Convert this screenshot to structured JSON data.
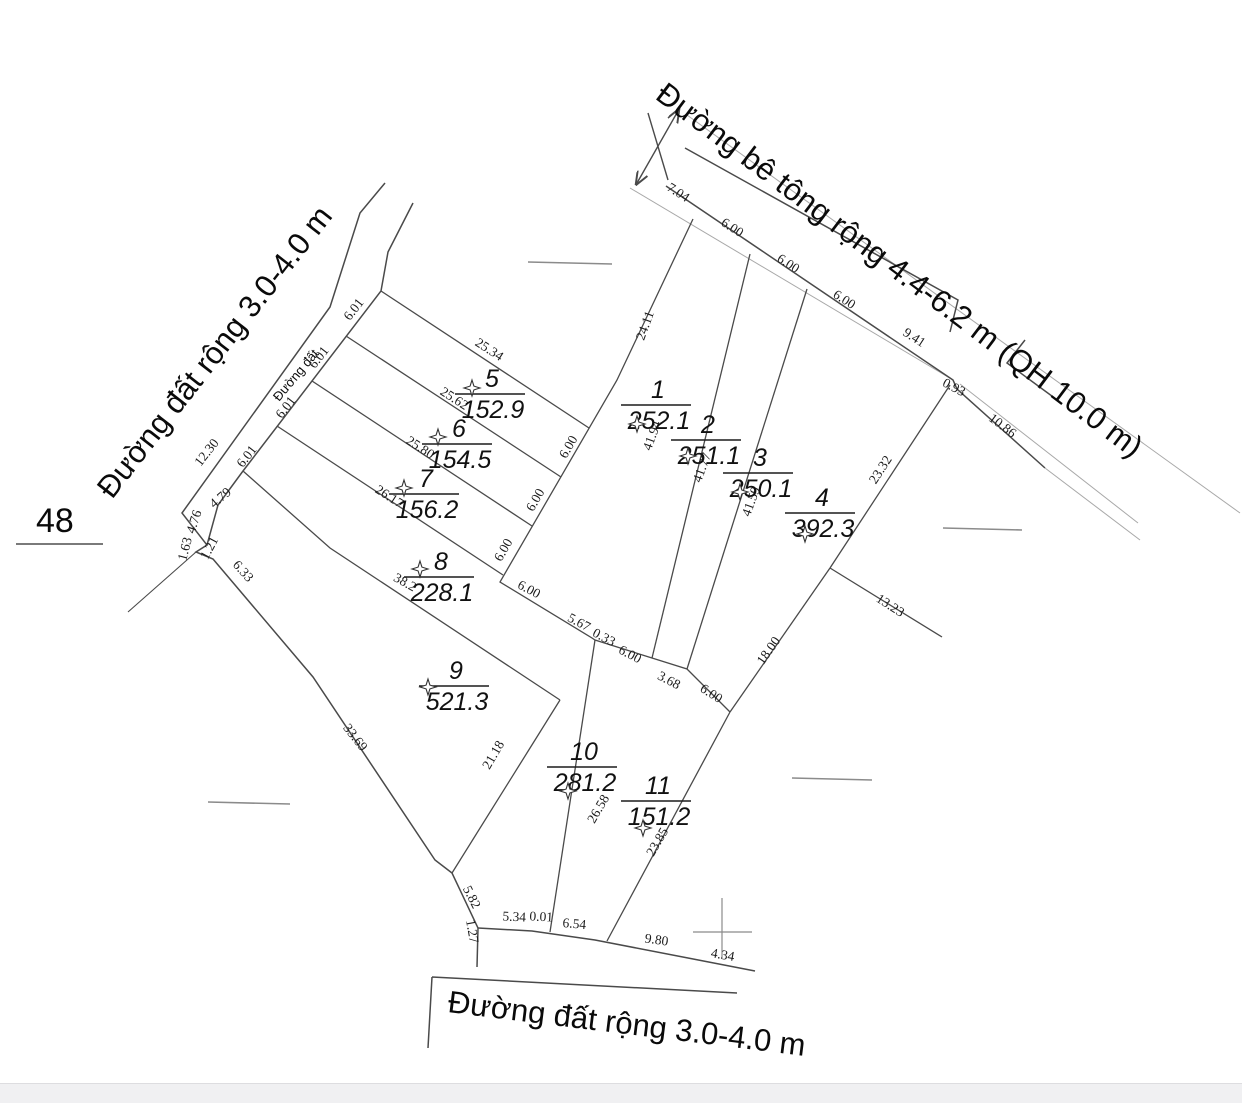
{
  "drawing": {
    "colors": {
      "line": "#4a4a4a",
      "thin_line": "#a0a0a0",
      "text": "#1c1c1c",
      "footer_bar": "#f0f0f2"
    },
    "block_number": {
      "text": "48",
      "x": 36,
      "y": 532,
      "size": 34,
      "underline": [
        16,
        544,
        103,
        544
      ]
    },
    "road_labels": [
      {
        "id": "road-concrete",
        "text": "Đường bê tông rộng 4.4-6.2 m (QH 10.0 m)",
        "x": 654,
        "y": 98,
        "rotation": 37,
        "size": 31
      },
      {
        "id": "road-dirt-left",
        "text": "Đường đất rộng 3.0-4.0 m",
        "x": 112,
        "y": 500,
        "rotation": -52,
        "size": 31
      },
      {
        "id": "road-dirt-bottom",
        "text": "Đường đất rộng 3.0-4.0 m",
        "x": 447,
        "y": 1012,
        "rotation": 7,
        "size": 31
      },
      {
        "id": "path-dirt-small",
        "text": "Đường đất",
        "x": 279,
        "y": 402,
        "rotation": -50,
        "size": 13
      }
    ],
    "parcels": [
      {
        "number": "1",
        "area": "252.1",
        "cx": 658,
        "cy": 405,
        "star": [
          637,
          424
        ]
      },
      {
        "number": "2",
        "area": "251.1",
        "cx": 708,
        "cy": 440,
        "star": [
          688,
          456
        ]
      },
      {
        "number": "3",
        "area": "250.1",
        "cx": 760,
        "cy": 473,
        "star": [
          740,
          492
        ]
      },
      {
        "number": "4",
        "area": "392.3",
        "cx": 822,
        "cy": 513,
        "star": [
          805,
          534
        ]
      },
      {
        "number": "5",
        "area": "152.9",
        "cx": 492,
        "cy": 394,
        "star": [
          472,
          388
        ]
      },
      {
        "number": "6",
        "area": "154.5",
        "cx": 459,
        "cy": 444,
        "star": [
          438,
          437
        ]
      },
      {
        "number": "7",
        "area": "156.2",
        "cx": 426,
        "cy": 494,
        "star": [
          404,
          488
        ]
      },
      {
        "number": "8",
        "area": "228.1",
        "cx": 441,
        "cy": 577,
        "star": [
          420,
          569
        ]
      },
      {
        "number": "9",
        "area": "521.3",
        "cx": 456,
        "cy": 686,
        "star": [
          428,
          687
        ]
      },
      {
        "number": "10",
        "area": "281.2",
        "cx": 584,
        "cy": 767,
        "star": [
          568,
          791
        ]
      },
      {
        "number": "11",
        "area": "151.2",
        "cx": 658,
        "cy": 801,
        "star": [
          643,
          828
        ]
      }
    ],
    "dimensions": [
      {
        "text": "7.04",
        "x": 676,
        "y": 196,
        "r": 33
      },
      {
        "text": "6.00",
        "x": 730,
        "y": 231,
        "r": 33
      },
      {
        "text": "6.00",
        "x": 786,
        "y": 267,
        "r": 33
      },
      {
        "text": "6.00",
        "x": 842,
        "y": 303,
        "r": 33
      },
      {
        "text": "9.41",
        "x": 912,
        "y": 341,
        "r": 33
      },
      {
        "text": "0.93",
        "x": 952,
        "y": 391,
        "r": 28
      },
      {
        "text": "10.86",
        "x": 1000,
        "y": 429,
        "r": 37
      },
      {
        "text": "6.01",
        "x": 357,
        "y": 312,
        "r": -52
      },
      {
        "text": "6.01",
        "x": 322,
        "y": 360,
        "r": -52
      },
      {
        "text": "6.01",
        "x": 289,
        "y": 410,
        "r": -52
      },
      {
        "text": "6.01",
        "x": 250,
        "y": 459,
        "r": -52
      },
      {
        "text": "12.30",
        "x": 210,
        "y": 455,
        "r": -52
      },
      {
        "text": "4.79",
        "x": 223,
        "y": 501,
        "r": -40
      },
      {
        "text": "4.76",
        "x": 198,
        "y": 523,
        "r": -72
      },
      {
        "text": "1.63",
        "x": 189,
        "y": 550,
        "r": -75
      },
      {
        "text": "1.21",
        "x": 213,
        "y": 550,
        "r": -62
      },
      {
        "text": "6.33",
        "x": 240,
        "y": 574,
        "r": 48
      },
      {
        "text": "33.69",
        "x": 352,
        "y": 740,
        "r": 52
      },
      {
        "text": "5.82",
        "x": 468,
        "y": 899,
        "r": 63
      },
      {
        "text": "1.27",
        "x": 468,
        "y": 932,
        "r": 80
      },
      {
        "text": "5.34",
        "x": 514,
        "y": 921,
        "r": 3
      },
      {
        "text": "0.01",
        "x": 541,
        "y": 921,
        "r": 3
      },
      {
        "text": "6.54",
        "x": 574,
        "y": 928,
        "r": 5
      },
      {
        "text": "9.80",
        "x": 656,
        "y": 944,
        "r": 8
      },
      {
        "text": "4.34",
        "x": 722,
        "y": 959,
        "r": 10
      },
      {
        "text": "25.34",
        "x": 487,
        "y": 353,
        "r": 33
      },
      {
        "text": "25.62",
        "x": 452,
        "y": 402,
        "r": 33
      },
      {
        "text": "25.80",
        "x": 418,
        "y": 451,
        "r": 33
      },
      {
        "text": "26.17",
        "x": 387,
        "y": 500,
        "r": 33
      },
      {
        "text": "38.2",
        "x": 403,
        "y": 586,
        "r": 29
      },
      {
        "text": "24.11",
        "x": 649,
        "y": 327,
        "r": -70
      },
      {
        "text": "41.94",
        "x": 656,
        "y": 437,
        "r": -70
      },
      {
        "text": "41.77",
        "x": 706,
        "y": 469,
        "r": -70
      },
      {
        "text": "41.59",
        "x": 755,
        "y": 503,
        "r": -70
      },
      {
        "text": "23.32",
        "x": 884,
        "y": 472,
        "r": -57
      },
      {
        "text": "18.00",
        "x": 772,
        "y": 653,
        "r": -55
      },
      {
        "text": "13.23",
        "x": 888,
        "y": 609,
        "r": 33
      },
      {
        "text": "6.00",
        "x": 572,
        "y": 449,
        "r": -60
      },
      {
        "text": "6.00",
        "x": 539,
        "y": 502,
        "r": -60
      },
      {
        "text": "6.00",
        "x": 507,
        "y": 552,
        "r": -60
      },
      {
        "text": "6.00",
        "x": 527,
        "y": 593,
        "r": 28
      },
      {
        "text": "5.67",
        "x": 577,
        "y": 626,
        "r": 28
      },
      {
        "text": "0.33",
        "x": 602,
        "y": 641,
        "r": 28
      },
      {
        "text": "6.00",
        "x": 628,
        "y": 658,
        "r": 28
      },
      {
        "text": "3.68",
        "x": 667,
        "y": 684,
        "r": 28
      },
      {
        "text": "6.00",
        "x": 709,
        "y": 697,
        "r": 33
      },
      {
        "text": "21.18",
        "x": 497,
        "y": 757,
        "r": -60
      },
      {
        "text": "26.58",
        "x": 602,
        "y": 811,
        "r": -60
      },
      {
        "text": "23.85",
        "x": 661,
        "y": 844,
        "r": -60
      }
    ]
  }
}
